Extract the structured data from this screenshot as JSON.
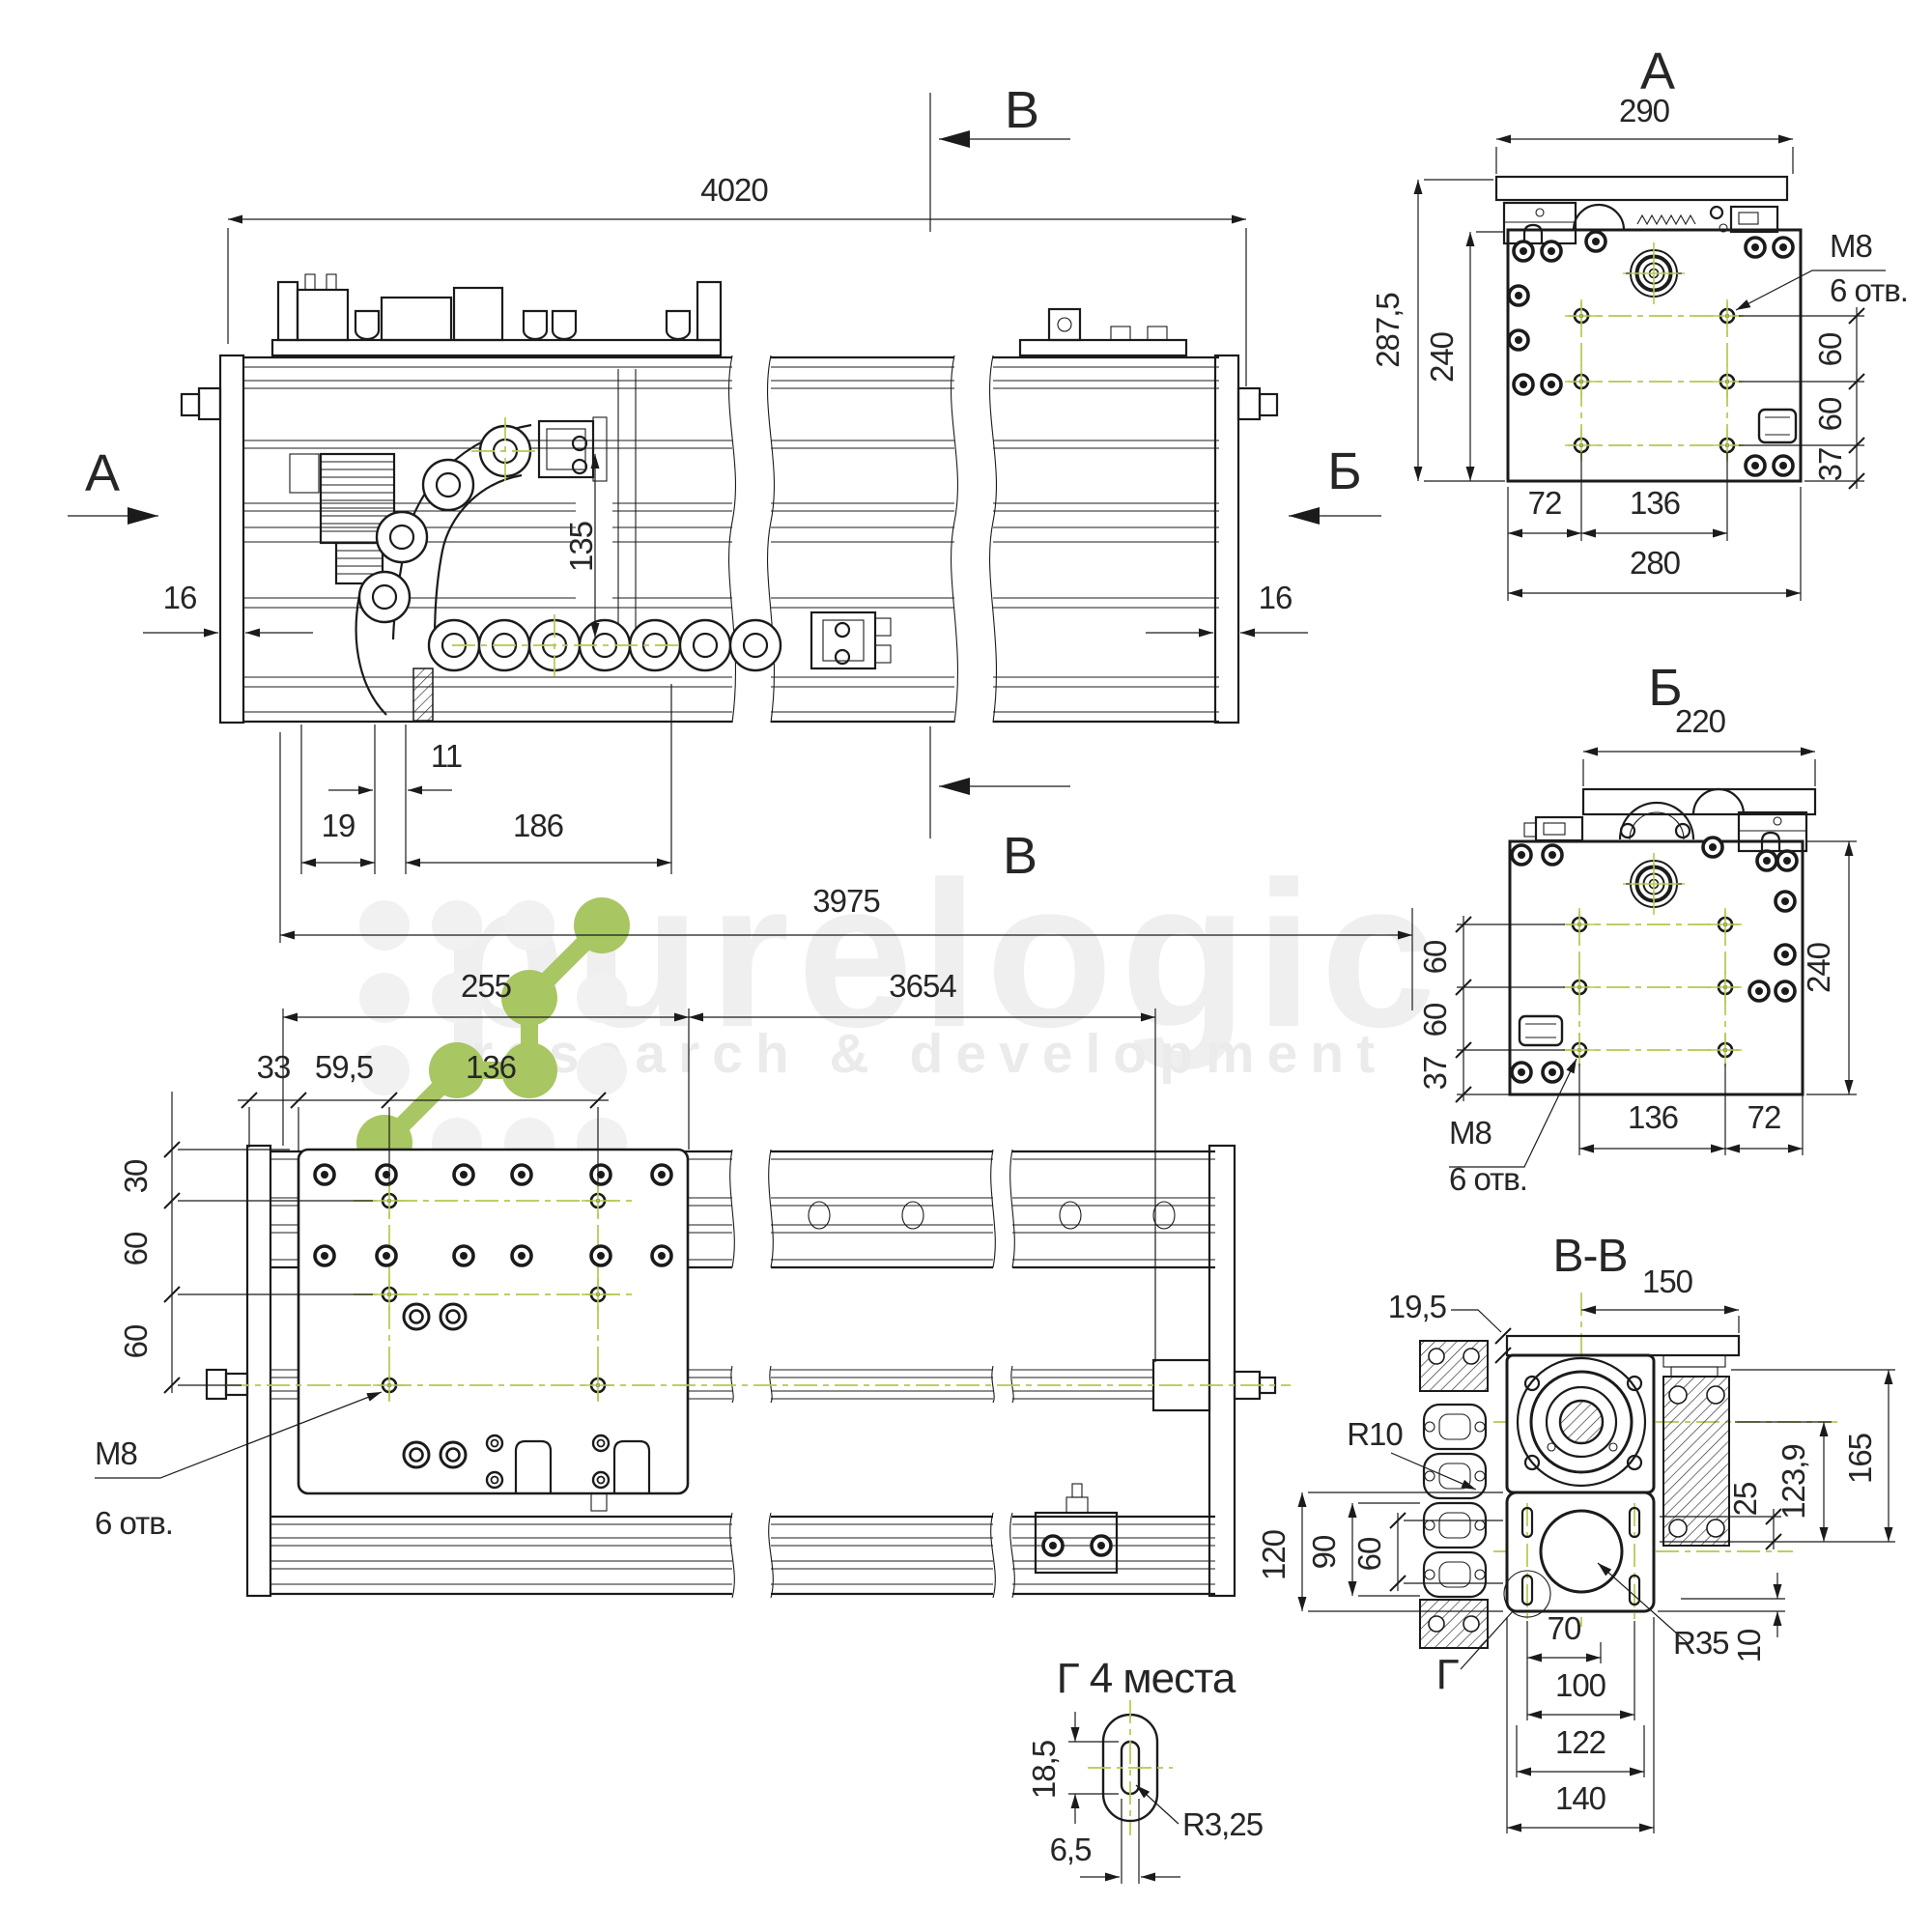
{
  "watermark": {
    "brand": "purelogic",
    "tagline": "research & development"
  },
  "colors": {
    "line": "#1b1b1b",
    "centerline": "#b5c84e",
    "logo_green": "#a8c662",
    "watermark_gray": "#efefef"
  },
  "views": {
    "main": {
      "section_label_top": "В",
      "section_label_bottom": "В",
      "view_label_left": "А",
      "view_label_right": "Б",
      "dims": {
        "overall": "4020",
        "left_plate": "16",
        "right_plate": "16",
        "chain_height": "135",
        "offset_11": "11",
        "offset_19": "19",
        "offset_186": "186"
      }
    },
    "plan": {
      "dims": {
        "rail_length": "3975",
        "carriage_left": "255",
        "travel": "3654",
        "d33": "33",
        "d59_5": "59,5",
        "d136": "136",
        "d30": "30",
        "d60_top": "60",
        "d60_bottom": "60"
      },
      "callout_thread": "М8",
      "callout_holes": "6 отв."
    },
    "view_a": {
      "title": "А",
      "dims": {
        "top_width": "290",
        "total_height": "287,5",
        "body_height": "240",
        "d60_top": "60",
        "d60_mid": "60",
        "d37": "37",
        "d72": "72",
        "d136": "136",
        "body_width": "280"
      },
      "callout_thread": "М8",
      "callout_holes": "6 отв."
    },
    "view_b": {
      "title": "Б",
      "dims": {
        "top_width": "220",
        "body_height": "240",
        "d60_top": "60",
        "d60_mid": "60",
        "d37": "37",
        "d136": "136",
        "d72": "72"
      },
      "callout_thread": "М8",
      "callout_holes": "6 отв."
    },
    "section_v": {
      "title": "В-В",
      "detail_label": "Г",
      "dims": {
        "d150": "150",
        "d19_5": "19,5",
        "r10": "R10",
        "d120": "120",
        "d90": "90",
        "d60": "60",
        "d25": "25",
        "d123_9": "123,9",
        "d165": "165",
        "d70": "70",
        "d100": "100",
        "d122": "122",
        "d140": "140",
        "r35": "R35",
        "d10": "10"
      }
    },
    "detail_g": {
      "title": "Г 4 места",
      "dims": {
        "d18_5": "18,5",
        "r3_25": "R3,25",
        "d6_5": "6,5"
      }
    }
  }
}
